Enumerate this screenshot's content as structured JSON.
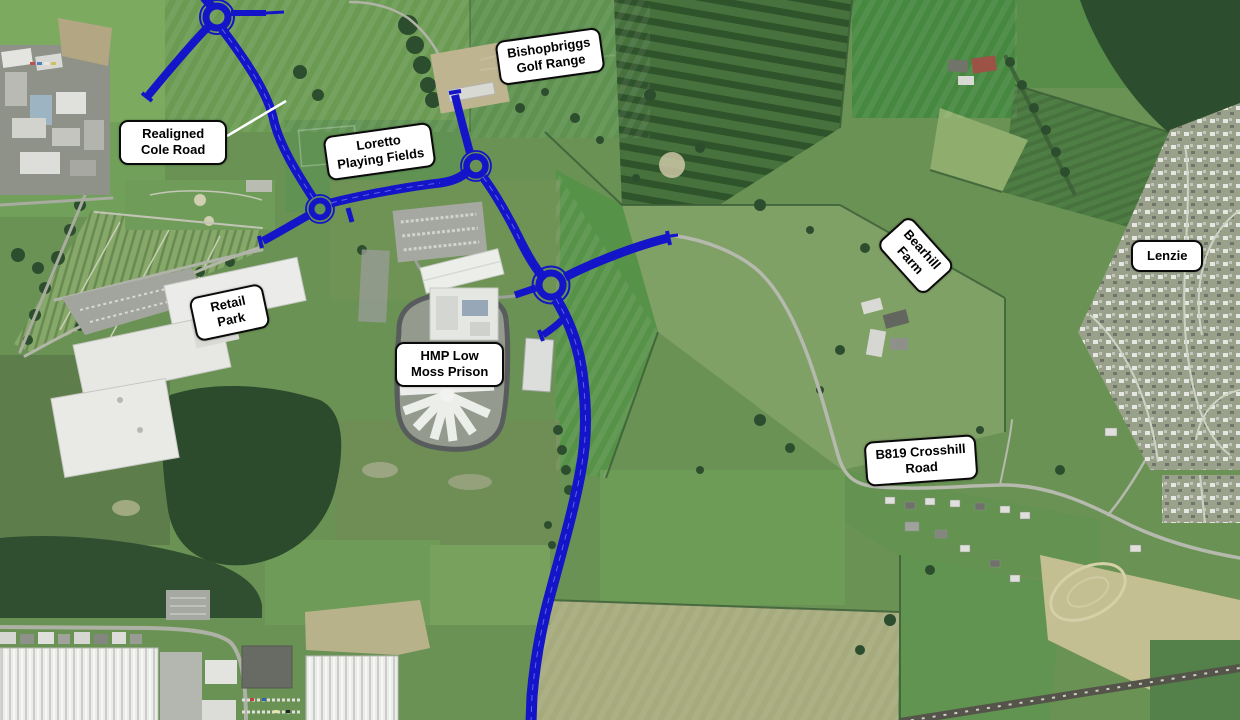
{
  "map": {
    "figure": "annotated-aerial-plan",
    "labels": [
      {
        "id": "bishopbriggs-golf-range",
        "text": "Bishopbriggs\nGolf Range"
      },
      {
        "id": "realigned-cole-road",
        "text": "Realigned\nCole Road"
      },
      {
        "id": "loretto-playing-fields",
        "text": "Loretto\nPlaying Fields"
      },
      {
        "id": "retail-park",
        "text": "Retail\nPark"
      },
      {
        "id": "hmp-low-moss-prison",
        "text": "HMP Low\nMoss Prison"
      },
      {
        "id": "bearhill-farm",
        "text": "Bearhill\nFarm"
      },
      {
        "id": "lenzie",
        "text": "Lenzie"
      },
      {
        "id": "b819-crosshill-road",
        "text": "B819 Crosshill\nRoad"
      }
    ],
    "colors": {
      "route_blue": "#1414c8",
      "route_inner_blue": "#5a5af0",
      "label_background": "#ffffff",
      "label_border": "#0a0a0a",
      "label_text": "#000000",
      "leader_line": "#ffffff"
    }
  }
}
